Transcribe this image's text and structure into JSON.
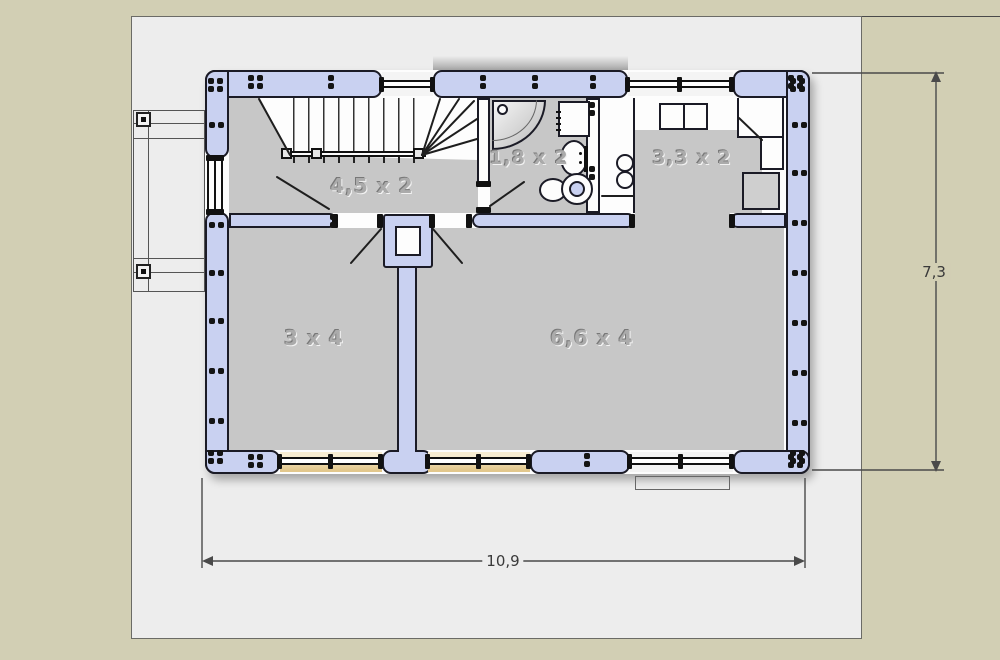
{
  "plan": {
    "rooms": [
      {
        "name": "hall",
        "label": "4,5 x 2"
      },
      {
        "name": "bathroom",
        "label": "1,8 x 2"
      },
      {
        "name": "kitchen",
        "label": "3,3 x 2"
      },
      {
        "name": "small-room",
        "label": "3 x 4"
      },
      {
        "name": "living-room",
        "label": "6,6 x 4"
      }
    ],
    "dimensions": {
      "width_label": "10,9",
      "height_label": "7,3"
    },
    "colors": {
      "background": "#d2cfb4",
      "page": "#ededed",
      "wall": "#c9d1f1",
      "floor": "#c7c7c7",
      "window_sill": "#e2c78c",
      "outline": "#1b1b26"
    },
    "fixtures": [
      "staircase",
      "railing",
      "chimney",
      "shower",
      "washing-machine",
      "bathroom-sink",
      "toilet",
      "kitchen-sink",
      "stove",
      "corner-cabinet",
      "fridge",
      "porch",
      "entry-step",
      "entry-door",
      "window"
    ]
  }
}
